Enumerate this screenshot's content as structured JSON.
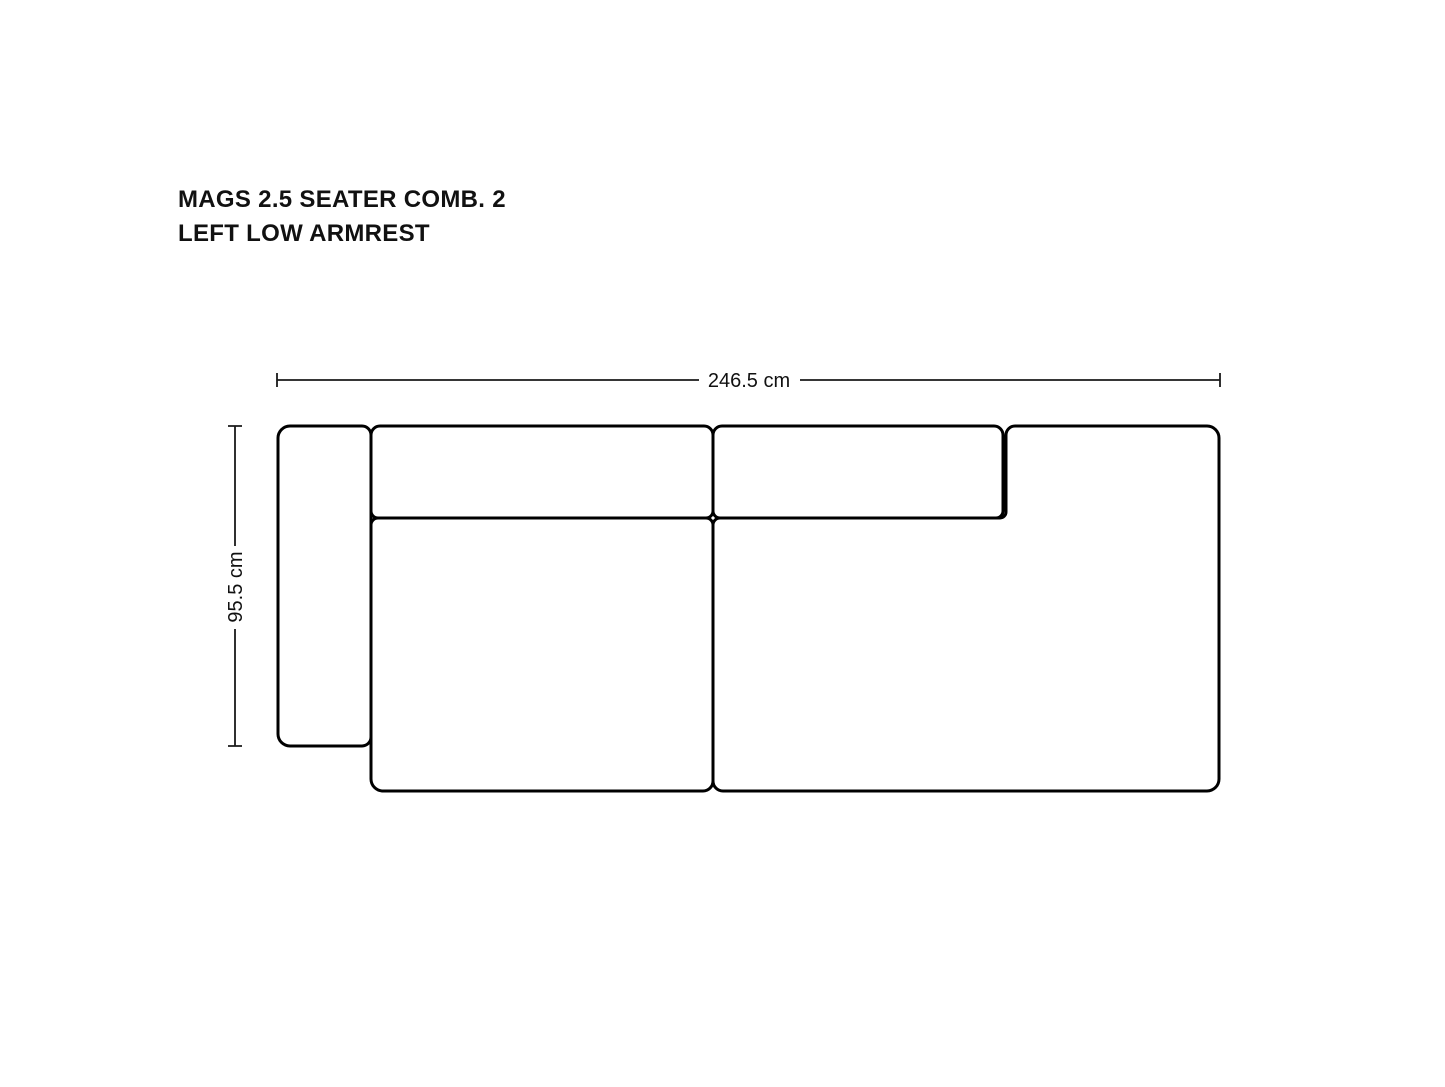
{
  "title": {
    "line1": "MAGS 2.5 SEATER COMB. 2",
    "line2": "LEFT LOW ARMREST"
  },
  "dimensions": {
    "width": {
      "label": "246.5 cm",
      "value_cm": 246.5
    },
    "depth": {
      "label": "95.5 cm",
      "value_cm": 95.5
    }
  },
  "product": {
    "name": "MAGS 2.5 SEATER COMB. 2",
    "variant": "LEFT LOW ARMREST",
    "parts": [
      "left low armrest",
      "left backrest cushion",
      "left seat module",
      "right backrest cushion",
      "right seat module"
    ]
  },
  "colors": {
    "background": "#ffffff",
    "outline": "#000000",
    "dimension_line": "#1a1a1a",
    "text": "#111111"
  }
}
